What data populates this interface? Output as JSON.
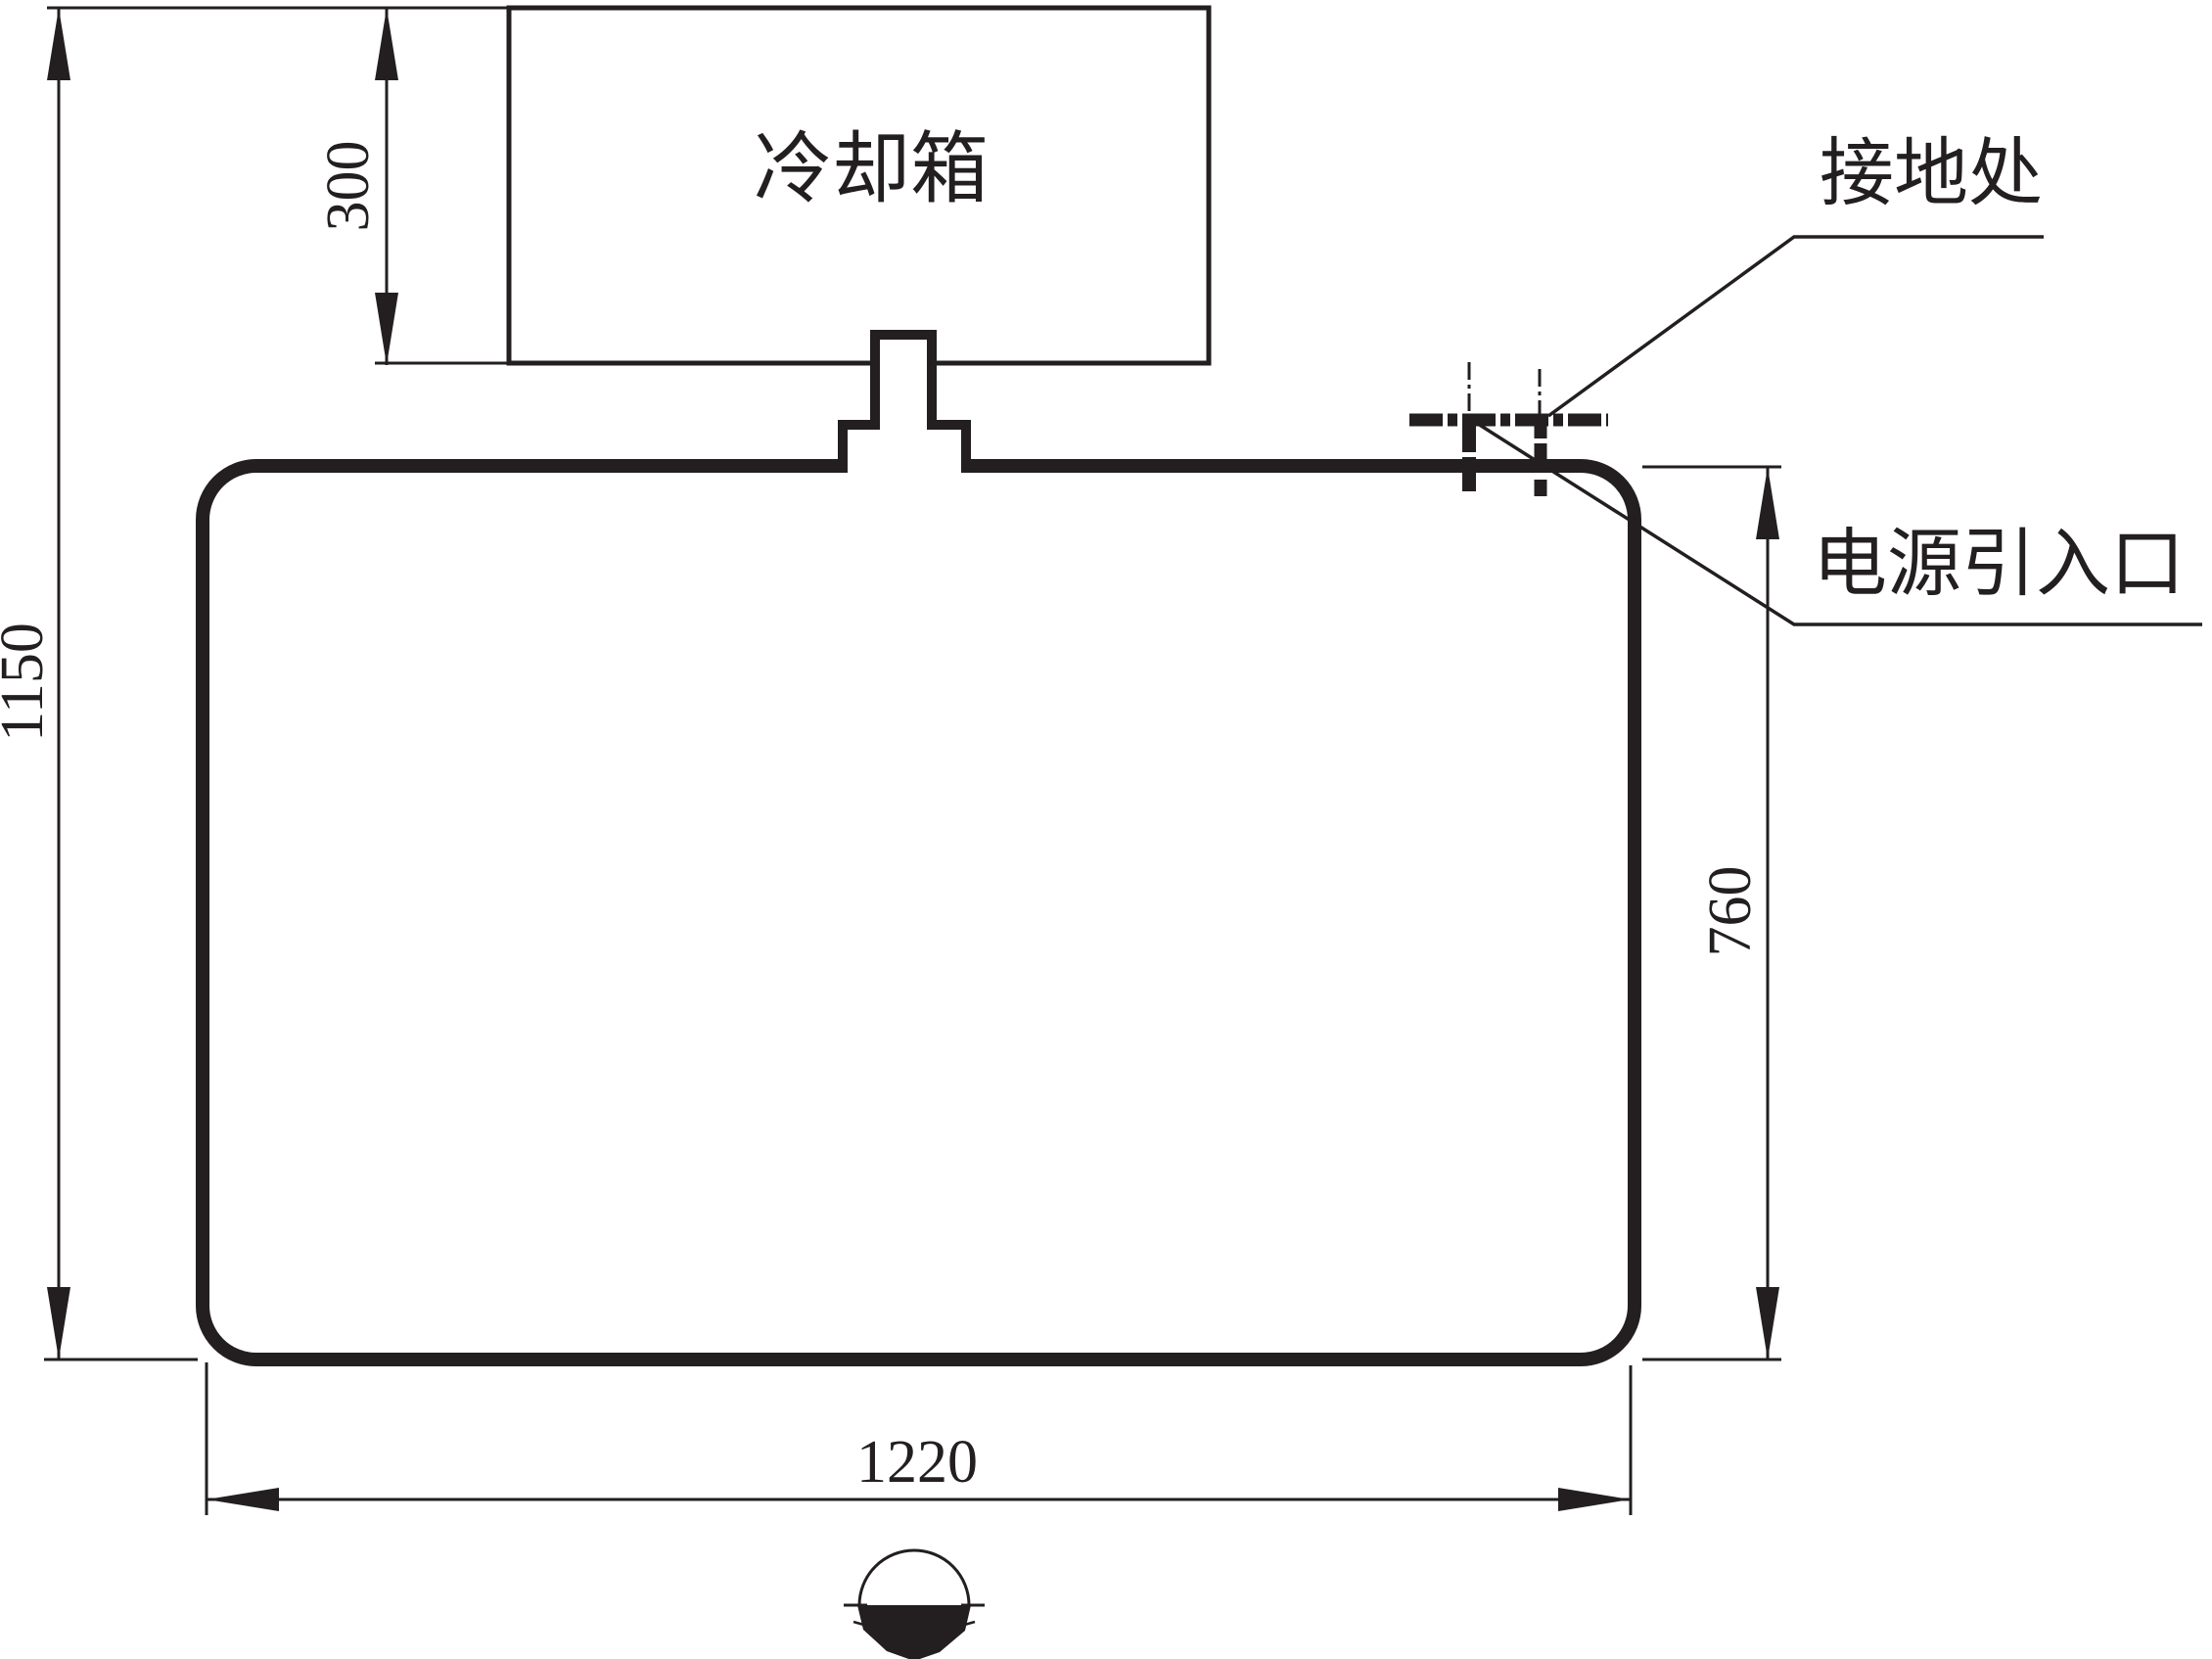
{
  "drawing": {
    "cooling_box_label": "冷却箱",
    "grounding_label": "接地处",
    "power_inlet_label": "电源引入口",
    "dimensions": {
      "total_height": "1150",
      "cooling_box_height": "300",
      "body_height": "760",
      "body_width": "1220"
    },
    "line_color": "#231f20"
  }
}
